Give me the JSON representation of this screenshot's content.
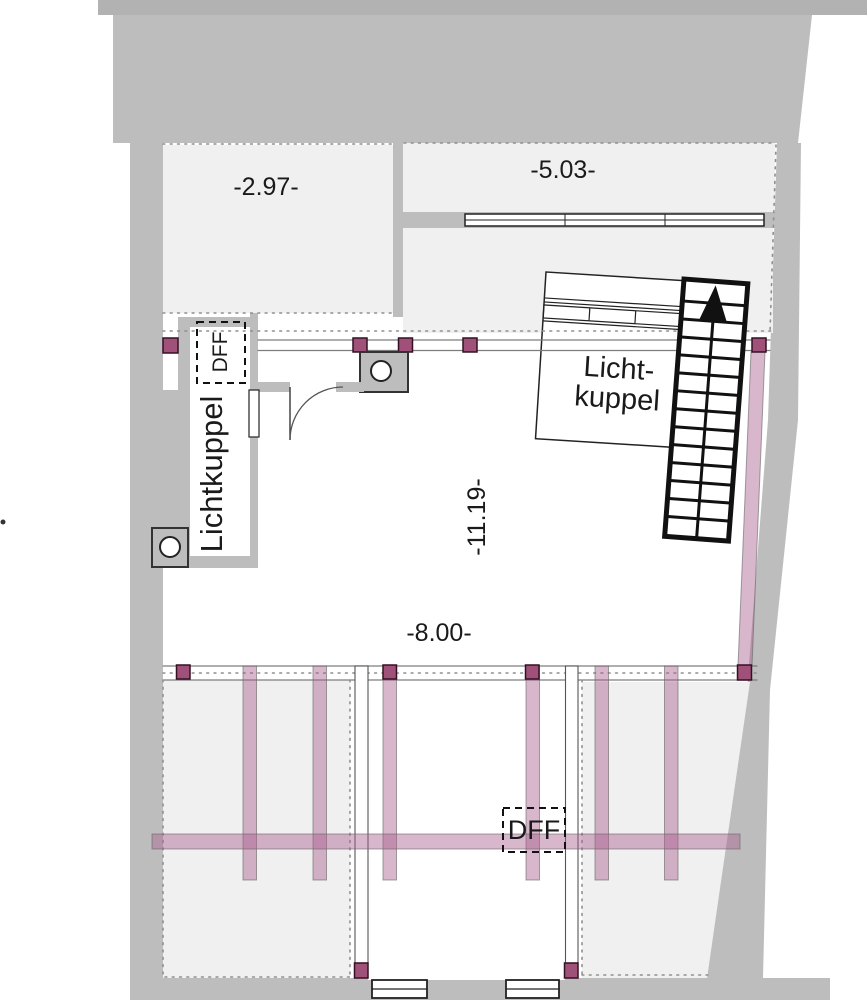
{
  "title": "Dachgeschoss Grundriss (roof floor plan)",
  "labels": {
    "room_top_left_dim": "-2.97-",
    "room_top_right_dim": "-5.03-",
    "shaft_dff": "DFF",
    "shaft_name": "Lichtkuppel",
    "skylight_box_line1": "Licht-",
    "skylight_box_line2": "kuppel",
    "room_depth_dim": "-11.19-",
    "room_width_dim": "-8.00-",
    "roof_window_dff": "DFF"
  },
  "colors": {
    "wall": "#bdbdbd",
    "wall-top": "#b2b2b2",
    "room": "#f0f0f0",
    "beam": "#a85e8c",
    "post": "#9f5179",
    "post-border": "#351024",
    "stairs": "#111111",
    "thin-line": "#7d7d7d",
    "dot-line": "#8f8f8f",
    "text": "#1a1a1a"
  }
}
